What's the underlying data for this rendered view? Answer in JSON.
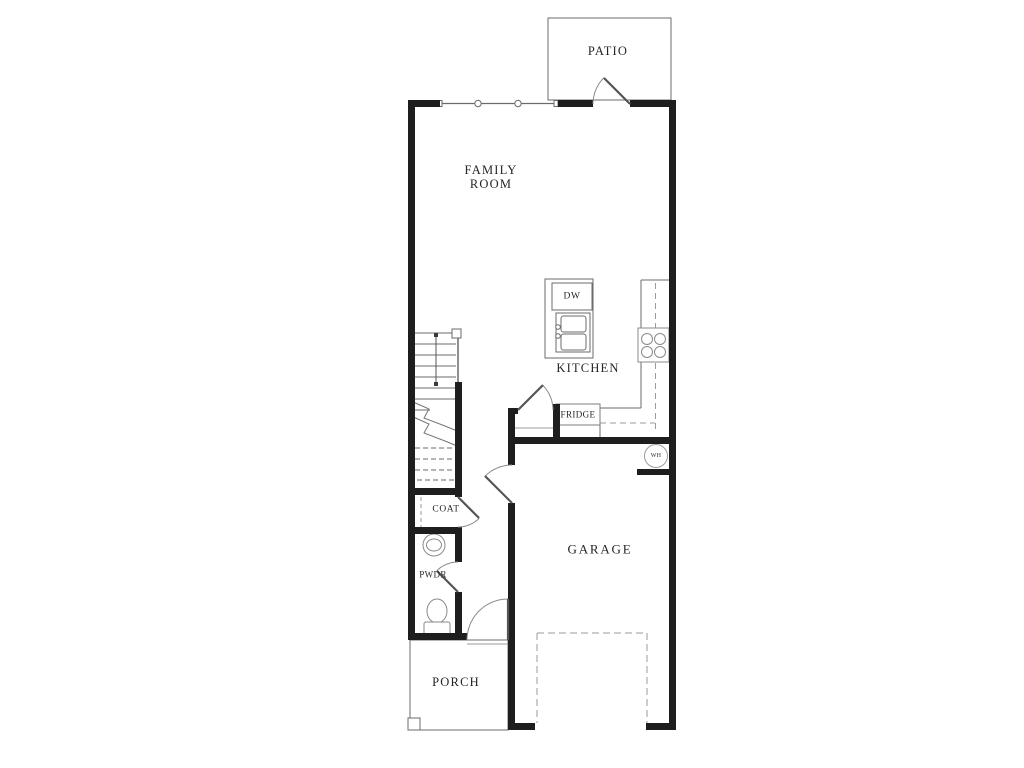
{
  "rooms": {
    "patio": "PATIO",
    "family_room_line1": "FAMILY",
    "family_room_line2": "ROOM",
    "kitchen": "KITCHEN",
    "garage": "GARAGE",
    "porch": "PORCH",
    "coat_closet": "COAT",
    "powder_room": "PWDR"
  },
  "appliances": {
    "dishwasher": "DW",
    "refrigerator": "FRIDGE",
    "water_heater": "WH"
  },
  "colors": {
    "background": "#ffffff",
    "wall_ink": "#1e1e1e",
    "thin_line_ink": "#6b6b6b",
    "dashed_line_ink": "#9b9b9b",
    "text_ink": "#252525"
  }
}
